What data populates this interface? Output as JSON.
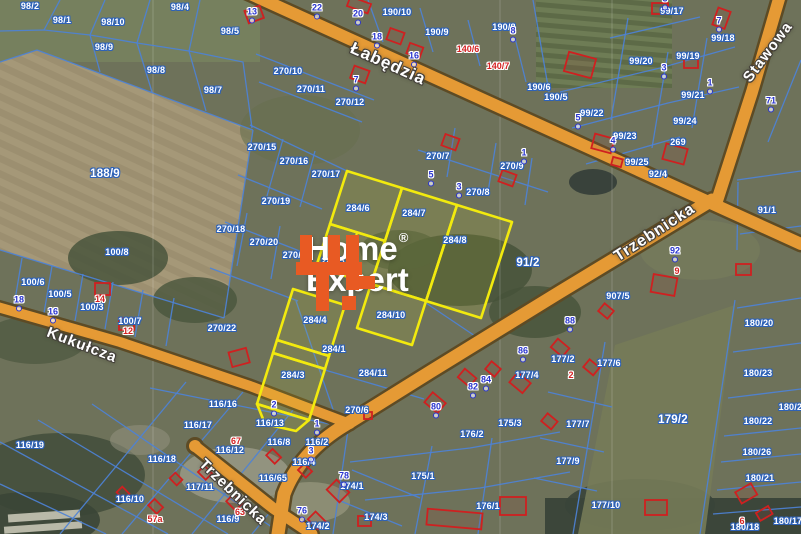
{
  "watermark": {
    "line1": "Home",
    "line2": "Expert",
    "reg": "®"
  },
  "colors": {
    "road_fill": "#e59a35",
    "road_casing": "#5d4b25",
    "parcel_line": "#4d82d6",
    "highlight": "#f2ea0e",
    "building": "#cf2020",
    "label_outline": "#2e62b8",
    "house_number": "#2a35cf",
    "red_number": "#d42222",
    "watermark_orange": "#e85a23"
  },
  "streets": [
    {
      "name": "Łabędzia",
      "x": 388,
      "y": 64,
      "rot": 24,
      "size": 17
    },
    {
      "name": "Stawowa",
      "x": 768,
      "y": 52,
      "rot": -53,
      "size": 15
    },
    {
      "name": "Trzebnicka",
      "x": 655,
      "y": 233,
      "rot": -33,
      "size": 16
    },
    {
      "name": "Kukułcza",
      "x": 82,
      "y": 345,
      "rot": 21,
      "size": 15
    },
    {
      "name": "Trzebnicka",
      "x": 233,
      "y": 492,
      "rot": 44,
      "size": 15
    }
  ],
  "parcel_labels": [
    {
      "t": "98/2",
      "x": 30,
      "y": 6
    },
    {
      "t": "98/1",
      "x": 62,
      "y": 20
    },
    {
      "t": "98/10",
      "x": 113,
      "y": 22
    },
    {
      "t": "98/4",
      "x": 180,
      "y": 7
    },
    {
      "t": "98/9",
      "x": 104,
      "y": 47
    },
    {
      "t": "98/8",
      "x": 156,
      "y": 70
    },
    {
      "t": "98/7",
      "x": 213,
      "y": 90
    },
    {
      "t": "98/5",
      "x": 230,
      "y": 31
    },
    {
      "t": "188/9",
      "x": 105,
      "y": 174,
      "big": true
    },
    {
      "t": "100/8",
      "x": 117,
      "y": 252
    },
    {
      "t": "270/10",
      "x": 288,
      "y": 71
    },
    {
      "t": "270/11",
      "x": 311,
      "y": 89
    },
    {
      "t": "270/12",
      "x": 350,
      "y": 102
    },
    {
      "t": "270/15",
      "x": 262,
      "y": 147
    },
    {
      "t": "270/16",
      "x": 294,
      "y": 161
    },
    {
      "t": "270/17",
      "x": 326,
      "y": 174
    },
    {
      "t": "270/19",
      "x": 276,
      "y": 201
    },
    {
      "t": "270/18",
      "x": 231,
      "y": 229
    },
    {
      "t": "270/20",
      "x": 264,
      "y": 242
    },
    {
      "t": "270/21",
      "x": 297,
      "y": 255
    },
    {
      "t": "270/22",
      "x": 222,
      "y": 328
    },
    {
      "t": "190/10",
      "x": 397,
      "y": 12
    },
    {
      "t": "190/9",
      "x": 437,
      "y": 32
    },
    {
      "t": "190/8",
      "x": 504,
      "y": 27
    },
    {
      "t": "190/6",
      "x": 539,
      "y": 87
    },
    {
      "t": "190/5",
      "x": 556,
      "y": 97
    },
    {
      "t": "270/7",
      "x": 438,
      "y": 156
    },
    {
      "t": "270/9",
      "x": 512,
      "y": 166
    },
    {
      "t": "270/8",
      "x": 478,
      "y": 192
    },
    {
      "t": "99/17",
      "x": 672,
      "y": 11
    },
    {
      "t": "99/18",
      "x": 723,
      "y": 38
    },
    {
      "t": "99/20",
      "x": 641,
      "y": 61
    },
    {
      "t": "99/19",
      "x": 688,
      "y": 56
    },
    {
      "t": "99/21",
      "x": 693,
      "y": 95
    },
    {
      "t": "99/22",
      "x": 592,
      "y": 113
    },
    {
      "t": "99/23",
      "x": 625,
      "y": 136
    },
    {
      "t": "99/24",
      "x": 685,
      "y": 121
    },
    {
      "t": "269",
      "x": 678,
      "y": 142
    },
    {
      "t": "99/25",
      "x": 637,
      "y": 162
    },
    {
      "t": "92/4",
      "x": 658,
      "y": 174
    },
    {
      "t": "91/1",
      "x": 767,
      "y": 210
    },
    {
      "t": "91/2",
      "x": 528,
      "y": 263,
      "big": true
    },
    {
      "t": "907/5",
      "x": 618,
      "y": 296
    },
    {
      "t": "177/2",
      "x": 563,
      "y": 359
    },
    {
      "t": "177/6",
      "x": 609,
      "y": 363
    },
    {
      "t": "177/4",
      "x": 527,
      "y": 375
    },
    {
      "t": "177/7",
      "x": 578,
      "y": 424
    },
    {
      "t": "177/9",
      "x": 568,
      "y": 461
    },
    {
      "t": "177/10",
      "x": 606,
      "y": 505
    },
    {
      "t": "179/2",
      "x": 673,
      "y": 420,
      "big": true
    },
    {
      "t": "180/20",
      "x": 759,
      "y": 323
    },
    {
      "t": "180/23",
      "x": 758,
      "y": 373
    },
    {
      "t": "180/24",
      "x": 793,
      "y": 407
    },
    {
      "t": "180/22",
      "x": 758,
      "y": 421
    },
    {
      "t": "180/26",
      "x": 757,
      "y": 452
    },
    {
      "t": "180/21",
      "x": 760,
      "y": 478
    },
    {
      "t": "180/18",
      "x": 745,
      "y": 527
    },
    {
      "t": "180/17",
      "x": 788,
      "y": 521
    },
    {
      "t": "284/6",
      "x": 358,
      "y": 208
    },
    {
      "t": "284/7",
      "x": 414,
      "y": 213
    },
    {
      "t": "284/8",
      "x": 455,
      "y": 240
    },
    {
      "t": "284/5",
      "x": 333,
      "y": 261
    },
    {
      "t": "284/4",
      "x": 315,
      "y": 320
    },
    {
      "t": "284/10",
      "x": 391,
      "y": 315
    },
    {
      "t": "284/1",
      "x": 334,
      "y": 349
    },
    {
      "t": "284/3",
      "x": 293,
      "y": 375
    },
    {
      "t": "284/11",
      "x": 373,
      "y": 373
    },
    {
      "t": "270/6",
      "x": 357,
      "y": 410
    },
    {
      "t": "100/6",
      "x": 33,
      "y": 282
    },
    {
      "t": "100/5",
      "x": 60,
      "y": 294
    },
    {
      "t": "100/3",
      "x": 92,
      "y": 307
    },
    {
      "t": "100/7",
      "x": 130,
      "y": 321
    },
    {
      "t": "116/16",
      "x": 223,
      "y": 404
    },
    {
      "t": "116/17",
      "x": 198,
      "y": 425
    },
    {
      "t": "116/13",
      "x": 270,
      "y": 423
    },
    {
      "t": "116/12",
      "x": 230,
      "y": 450
    },
    {
      "t": "116/8",
      "x": 279,
      "y": 442
    },
    {
      "t": "116/2",
      "x": 317,
      "y": 442
    },
    {
      "t": "116/4",
      "x": 304,
      "y": 462
    },
    {
      "t": "116/18",
      "x": 162,
      "y": 459
    },
    {
      "t": "116/65",
      "x": 273,
      "y": 478
    },
    {
      "t": "117/11",
      "x": 200,
      "y": 487
    },
    {
      "t": "116/10",
      "x": 130,
      "y": 499
    },
    {
      "t": "116/9",
      "x": 228,
      "y": 519
    },
    {
      "t": "116/19",
      "x": 30,
      "y": 445
    },
    {
      "t": "174/1",
      "x": 352,
      "y": 486
    },
    {
      "t": "174/3",
      "x": 376,
      "y": 517
    },
    {
      "t": "174/2",
      "x": 318,
      "y": 526
    },
    {
      "t": "175/3",
      "x": 510,
      "y": 423
    },
    {
      "t": "176/2",
      "x": 472,
      "y": 434
    },
    {
      "t": "175/1",
      "x": 423,
      "y": 476
    },
    {
      "t": "176/1",
      "x": 488,
      "y": 506
    }
  ],
  "house_numbers": [
    {
      "t": "22",
      "x": 317,
      "y": 11
    },
    {
      "t": "20",
      "x": 358,
      "y": 17
    },
    {
      "t": "18",
      "x": 377,
      "y": 40
    },
    {
      "t": "16",
      "x": 414,
      "y": 59
    },
    {
      "t": "7",
      "x": 356,
      "y": 83
    },
    {
      "t": "13",
      "x": 252,
      "y": 15
    },
    {
      "t": "8",
      "x": 513,
      "y": 34
    },
    {
      "t": "5",
      "x": 431,
      "y": 178
    },
    {
      "t": "3",
      "x": 459,
      "y": 190
    },
    {
      "t": "1",
      "x": 524,
      "y": 156
    },
    {
      "t": "3",
      "x": 665,
      "y": 2
    },
    {
      "t": "3",
      "x": 664,
      "y": 71
    },
    {
      "t": "7",
      "x": 719,
      "y": 24
    },
    {
      "t": "1",
      "x": 710,
      "y": 86
    },
    {
      "t": "5",
      "x": 578,
      "y": 121
    },
    {
      "t": "4",
      "x": 613,
      "y": 144
    },
    {
      "t": "71",
      "x": 771,
      "y": 104
    },
    {
      "t": "18",
      "x": 19,
      "y": 303
    },
    {
      "t": "16",
      "x": 53,
      "y": 315
    },
    {
      "t": "92",
      "x": 675,
      "y": 254
    },
    {
      "t": "88",
      "x": 570,
      "y": 324
    },
    {
      "t": "86",
      "x": 523,
      "y": 354
    },
    {
      "t": "84",
      "x": 486,
      "y": 383
    },
    {
      "t": "82",
      "x": 473,
      "y": 390
    },
    {
      "t": "80",
      "x": 436,
      "y": 410
    },
    {
      "t": "78",
      "x": 344,
      "y": 479
    },
    {
      "t": "76",
      "x": 302,
      "y": 514
    },
    {
      "t": "2",
      "x": 274,
      "y": 408
    },
    {
      "t": "1",
      "x": 317,
      "y": 427
    },
    {
      "t": "3",
      "x": 311,
      "y": 454
    }
  ],
  "red_numbers": [
    {
      "t": "14",
      "x": 100,
      "y": 299
    },
    {
      "t": "12",
      "x": 128,
      "y": 331
    },
    {
      "t": "140/6",
      "x": 468,
      "y": 49
    },
    {
      "t": "140/7",
      "x": 498,
      "y": 66
    },
    {
      "t": "2",
      "x": 571,
      "y": 375
    },
    {
      "t": "9",
      "x": 677,
      "y": 271
    },
    {
      "t": "57a",
      "x": 155,
      "y": 519
    },
    {
      "t": "63",
      "x": 240,
      "y": 512
    },
    {
      "t": "67",
      "x": 236,
      "y": 441
    },
    {
      "t": "6",
      "x": 742,
      "y": 521
    }
  ]
}
